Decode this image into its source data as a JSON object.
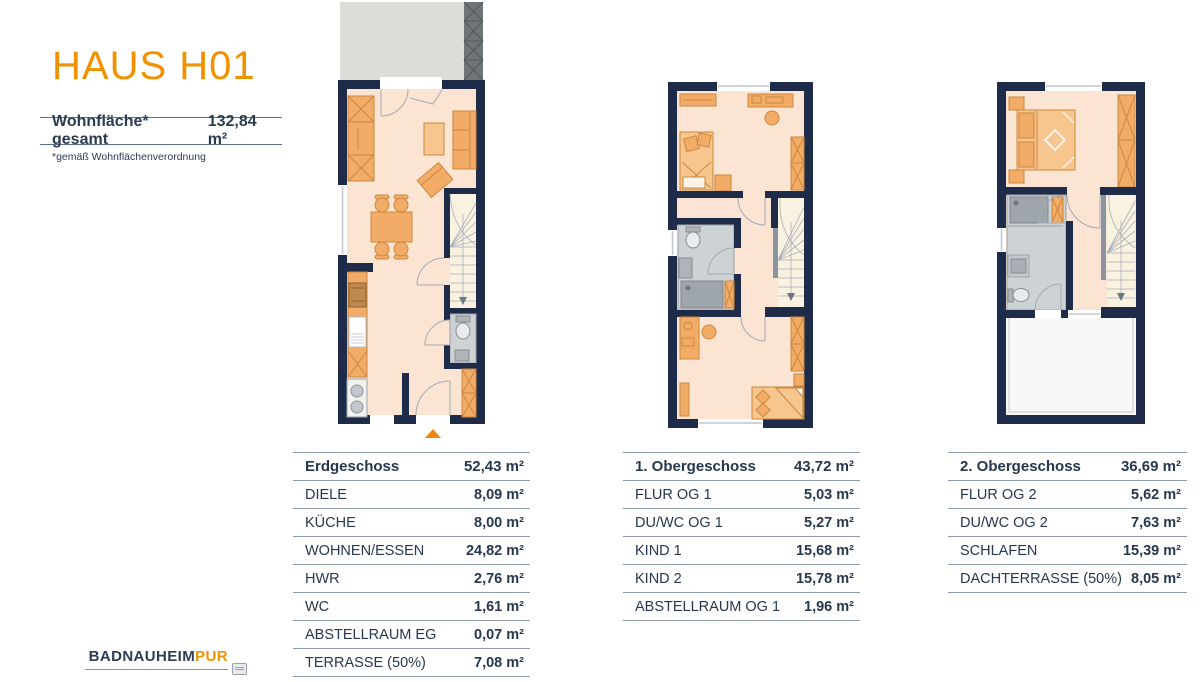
{
  "header": {
    "title": "HAUS H01",
    "area_label": "Wohnfläche* gesamt",
    "area_value": "132,84 m²",
    "footnote": "*gemäß Wohnflächenverordnung"
  },
  "tables": [
    {
      "title": "Erdgeschoss",
      "total": "52,43 m²",
      "rows": [
        {
          "label": "DIELE",
          "value": "8,09 m²"
        },
        {
          "label": "KÜCHE",
          "value": "8,00 m²"
        },
        {
          "label": "WOHNEN/ESSEN",
          "value": "24,82 m²"
        },
        {
          "label": "HWR",
          "value": "2,76 m²"
        },
        {
          "label": "WC",
          "value": "1,61 m²"
        },
        {
          "label": "ABSTELLRAUM EG",
          "value": "0,07 m²"
        },
        {
          "label": "TERRASSE (50%)",
          "value": "7,08 m²"
        }
      ]
    },
    {
      "title": "1. Obergeschoss",
      "total": "43,72 m²",
      "rows": [
        {
          "label": "FLUR OG 1",
          "value": "5,03 m²"
        },
        {
          "label": "DU/WC OG 1",
          "value": "5,27 m²"
        },
        {
          "label": "KIND 1",
          "value": "15,68 m²"
        },
        {
          "label": "KIND 2",
          "value": "15,78 m²"
        },
        {
          "label": "ABSTELLRAUM OG 1",
          "value": "1,96 m²"
        }
      ]
    },
    {
      "title": "2. Obergeschoss",
      "total": "36,69 m²",
      "rows": [
        {
          "label": "FLUR OG 2",
          "value": "5,62 m²"
        },
        {
          "label": "DU/WC OG 2",
          "value": "7,63 m²"
        },
        {
          "label": "SCHLAFEN",
          "value": "15,39 m²"
        },
        {
          "label": "DACHTERRASSE (50%)",
          "value": "8,05 m²"
        }
      ]
    }
  ],
  "footer": {
    "brand_primary": "BADNAUHEIM",
    "brand_accent": "PUR"
  },
  "colors": {
    "accent_orange": "#F29100",
    "wall_navy": "#1F2C49",
    "floor_peach": "#FBE4D2",
    "furniture_orange": "#F2AC67",
    "bath_gray": "#CDD2D5",
    "table_line": "#8C9CAE"
  }
}
